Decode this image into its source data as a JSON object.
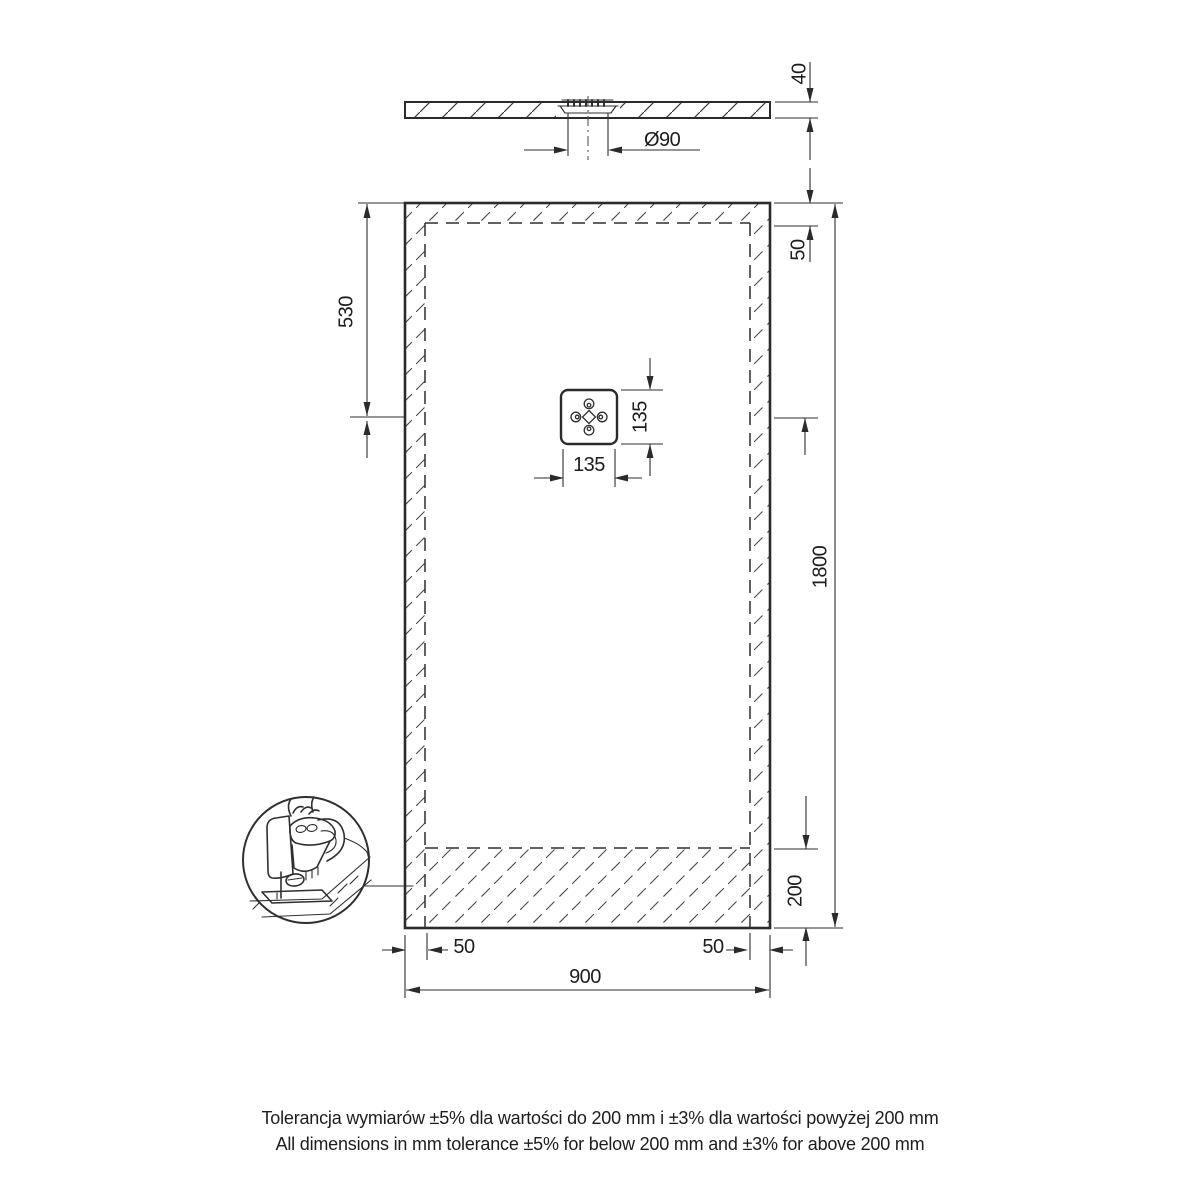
{
  "drawing": {
    "type": "technical-drawing",
    "subject": "rectangular shower tray with central square drain, trimmable edges"
  },
  "dims": {
    "profile_thickness": "40",
    "drain_diameter": "Ø90",
    "drain_offset_top": "530",
    "cut_margin_top": "50",
    "total_length": "1800",
    "cut_zone_bottom": "200",
    "drain_box_width": "135",
    "drain_box_height": "135",
    "cut_margin_left": "50",
    "cut_margin_right": "50",
    "total_width": "900"
  },
  "notes": {
    "tolerance_pl": "Tolerancja wymiarów ±5% dla wartości do 200 mm i ±3% dla wartości powyżej 200 mm",
    "tolerance_en": "All dimensions in mm tolerance ±5% for below 200 mm and ±3% for above 200 mm"
  },
  "icons": {
    "detail": "jigsaw-cutting-detail-icon",
    "drain": "drain-rosette-icon"
  },
  "colors": {
    "line": "#2b2b2b",
    "text": "#1d1d1d",
    "background": "#ffffff"
  }
}
